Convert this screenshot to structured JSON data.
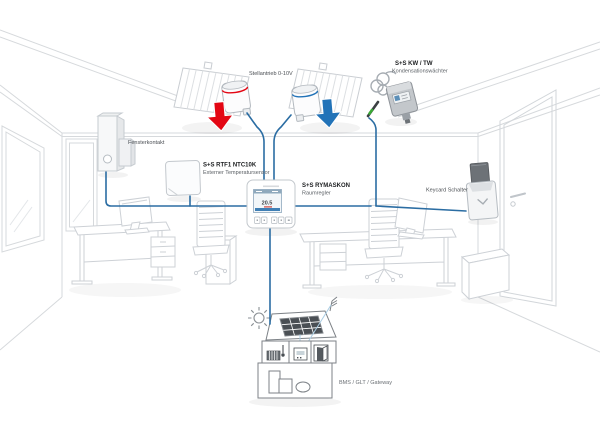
{
  "labels": {
    "stellantrieb": "Stellantrieb 0-10V",
    "fensterkontakt": "Fensterkontakt",
    "rtf1_name": "S+S RTF1 NTC10K",
    "rtf1_desc": "Externer Temperatursensor",
    "rymaskon_name": "S+S RYMASKON",
    "rymaskon_desc": "Raumregler",
    "kw_name": "S+S KW / TW",
    "kw_desc": "Kondensationswächter",
    "keycard": "Keycard Schalter",
    "bms": "BMS / GLT / Gateway"
  },
  "controller_display": {
    "temperature": "20.5"
  },
  "colors": {
    "connection_blue": "#2b6da3",
    "arrow_red": "#e30613",
    "arrow_blue": "#2273b8",
    "house_internal_blue": "#a9cde4"
  }
}
